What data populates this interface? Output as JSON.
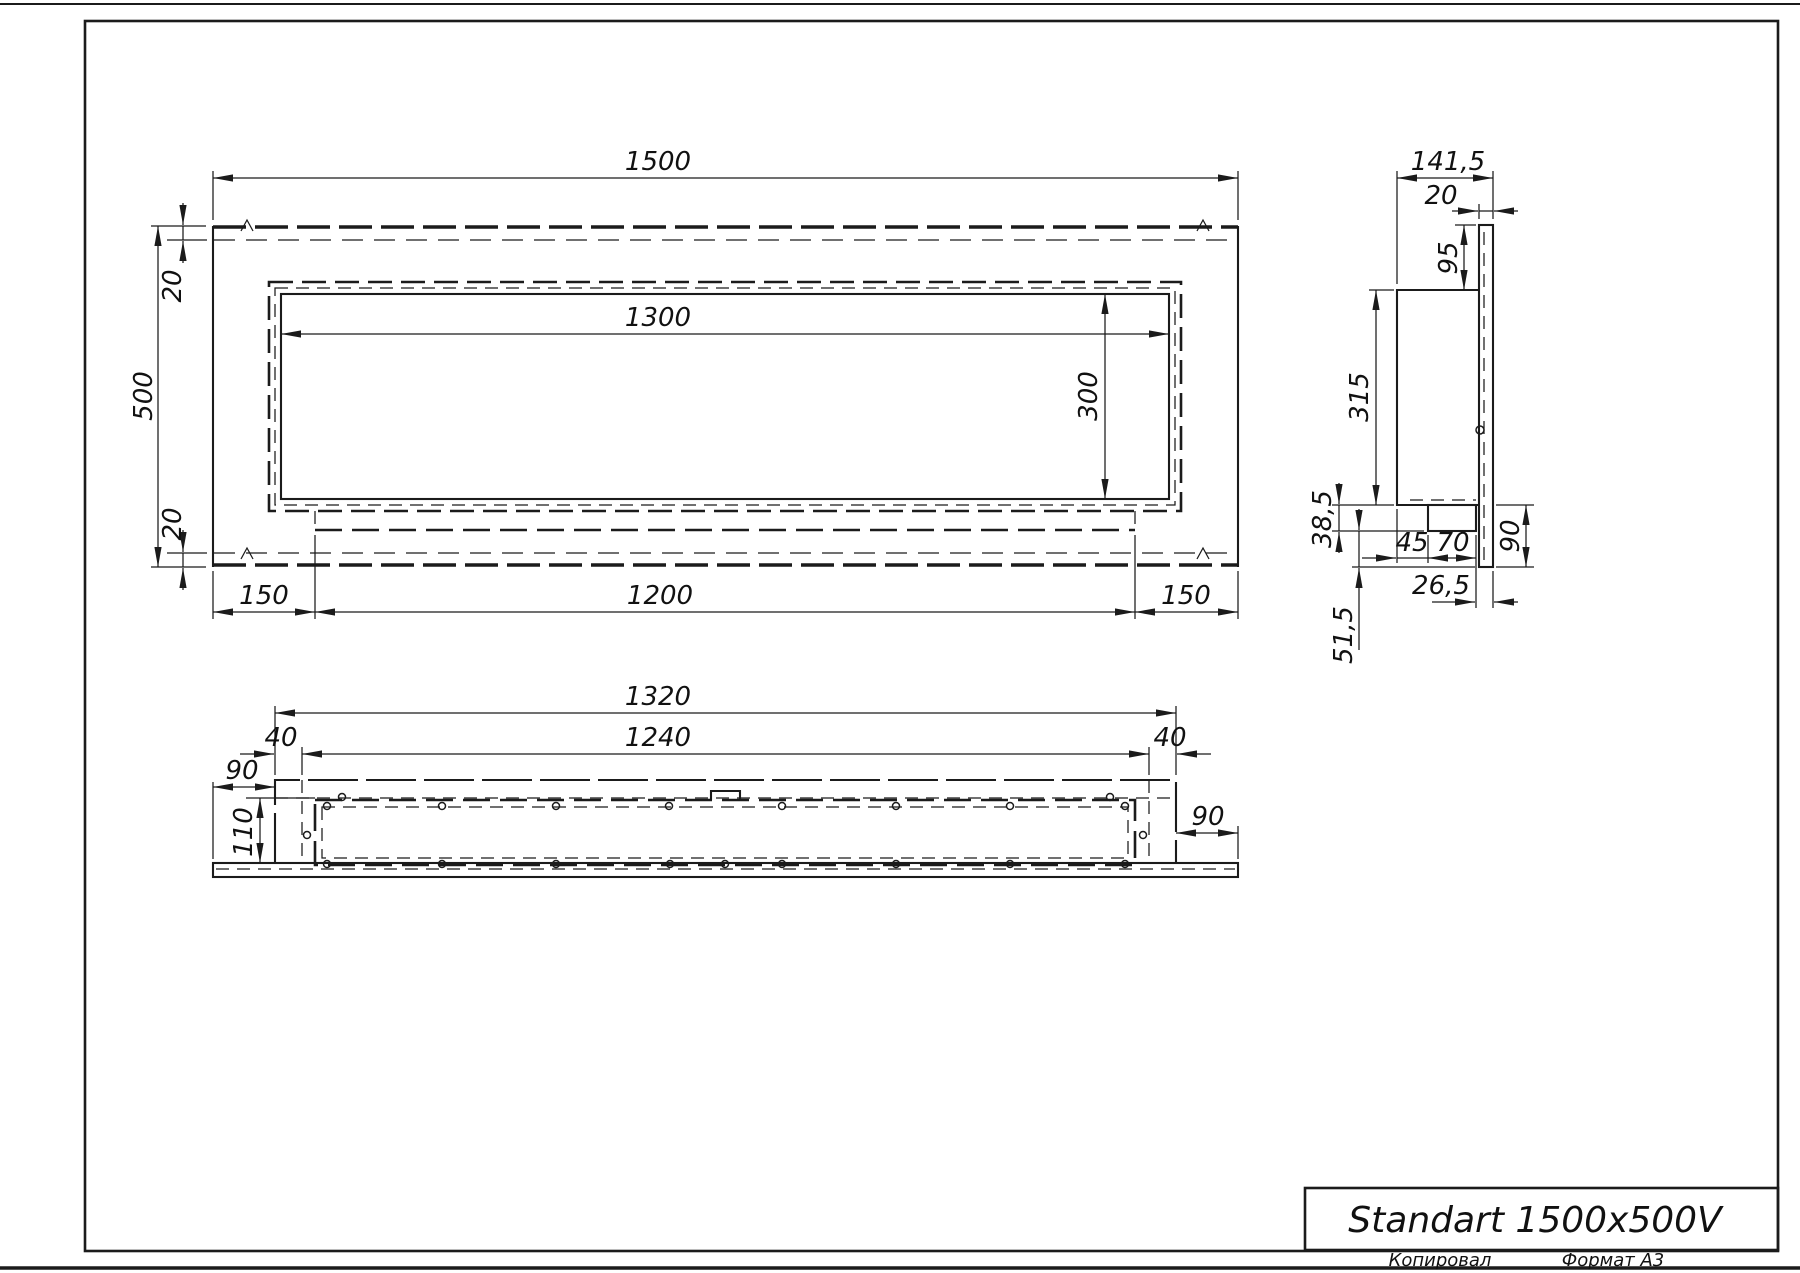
{
  "title_block": {
    "title": "Standart 1500x500V"
  },
  "sheet": {
    "copied_label": "Копировал",
    "format_label": "Формат A3"
  },
  "front_view": {
    "width": "1500",
    "height": "500",
    "top_offset": "20",
    "bottom_offset": "20",
    "opening_width": "1300",
    "opening_height": "300",
    "left_margin": "150",
    "tray_width": "1200",
    "right_margin": "150"
  },
  "side_view": {
    "depth": "141,5",
    "panel_thickness": "20",
    "top_overhang": "95",
    "body_height": "315",
    "tray_drop": "38,5",
    "tray_offset": "45",
    "tray_depth": "70",
    "bottom_overhang": "90",
    "front_gap": "26,5",
    "bottom_drop": "51,5"
  },
  "bottom_view": {
    "body_width": "1320",
    "opening_width": "1240",
    "wall_left": "40",
    "wall_right": "40",
    "panel_margin_left": "90",
    "panel_margin_right": "90",
    "depth": "110"
  }
}
